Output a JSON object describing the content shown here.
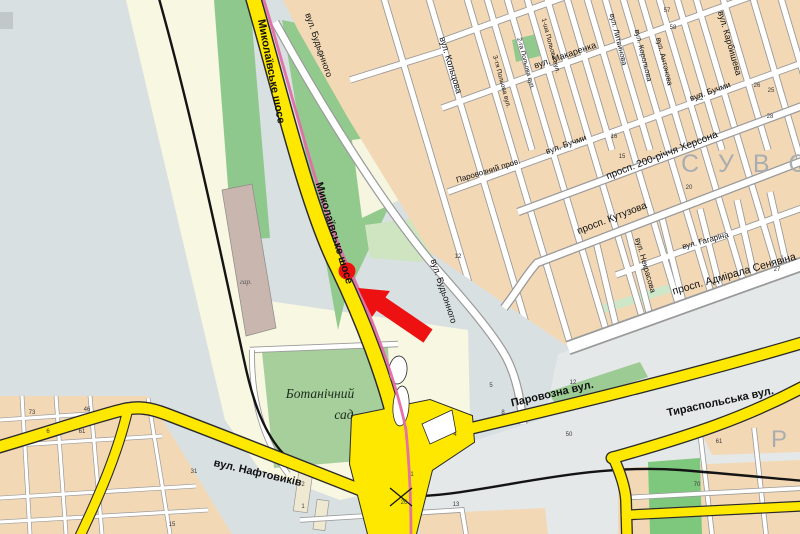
{
  "map": {
    "type": "city-street-map",
    "colors": {
      "background_field": "#d9e0e1",
      "primary_road_yellow": "#ffe800",
      "road_casing": "#2a2a2a",
      "minor_street_white": "#ffffff",
      "urban_block_tan": "#f3d8b6",
      "park_green": "#92ca8e",
      "garden_green": "#a6cf9c",
      "pale_land": "#f8f7e1",
      "tram_line_pink": "#e36ba6",
      "railway_black": "#141414",
      "marker_red": "#ee1111",
      "district_letters_grey": "#a9adb0"
    },
    "marker": {
      "dot_x": 347,
      "dot_y": 271,
      "arrow_tip_x": 358,
      "arrow_tip_y": 288
    },
    "labels": [
      {
        "t": "Миколаївське шосе",
        "x": 268,
        "y": 72,
        "r": 79,
        "s": 11,
        "w": 700
      },
      {
        "t": "Миколаївське шосе",
        "x": 331,
        "y": 234,
        "r": 73,
        "s": 11,
        "w": 700
      },
      {
        "t": "вул. Будьонного",
        "x": 316,
        "y": 46,
        "r": 71,
        "s": 9
      },
      {
        "t": "вул. Будьонного",
        "x": 441,
        "y": 292,
        "r": 72,
        "s": 9
      },
      {
        "t": "вул. Кольцова",
        "x": 448,
        "y": 66,
        "r": 73,
        "s": 9
      },
      {
        "t": "вул. Карбишева",
        "x": 727,
        "y": 44,
        "r": 74,
        "s": 9
      },
      {
        "t": "вул. Литвинова",
        "x": 616,
        "y": 40,
        "r": 76,
        "s": 7.5
      },
      {
        "t": "вул. Корольова",
        "x": 641,
        "y": 56,
        "r": 76,
        "s": 7.5
      },
      {
        "t": "вул. Антонова",
        "x": 662,
        "y": 62,
        "r": 76,
        "s": 7.5
      },
      {
        "t": "вул. Макаренка",
        "x": 566,
        "y": 58,
        "r": -19,
        "s": 9
      },
      {
        "t": "Паровозний пров.",
        "x": 489,
        "y": 173,
        "r": -17,
        "s": 8
      },
      {
        "t": "вул. Бучми",
        "x": 567,
        "y": 147,
        "r": -20,
        "s": 8.5
      },
      {
        "t": "вул. Бучми",
        "x": 711,
        "y": 94,
        "r": -20,
        "s": 8.5
      },
      {
        "t": "просп. 200-річчя Херсона",
        "x": 663,
        "y": 158,
        "r": -21,
        "s": 10
      },
      {
        "t": "просп. Кутузова",
        "x": 613,
        "y": 221,
        "r": -21,
        "s": 10
      },
      {
        "t": "вул. Некрасова",
        "x": 643,
        "y": 266,
        "r": 74,
        "s": 8
      },
      {
        "t": "вул. Гагаріна",
        "x": 706,
        "y": 243,
        "r": -15,
        "s": 8
      },
      {
        "t": "просп. Адмірала Сенявіна",
        "x": 735,
        "y": 277,
        "r": -16,
        "s": 10.5
      },
      {
        "t": "Паровозна вул.",
        "x": 553,
        "y": 397,
        "r": -13,
        "s": 11,
        "w": 700
      },
      {
        "t": "Тираспольська вул.",
        "x": 721,
        "y": 405,
        "r": -12,
        "s": 11,
        "w": 700
      },
      {
        "t": "вул. Нафтовиків",
        "x": 257,
        "y": 476,
        "r": 13,
        "s": 11,
        "w": 700
      },
      {
        "t": "1-ша Польова вул.",
        "x": 549,
        "y": 46,
        "r": 75,
        "s": 6.5
      },
      {
        "t": "2-га Польова вул.",
        "x": 524,
        "y": 64,
        "r": 75,
        "s": 6.5
      },
      {
        "t": "3-тя Польова вул.",
        "x": 500,
        "y": 82,
        "r": 75,
        "s": 6.5
      },
      {
        "t": "Ботанічний",
        "x": 320,
        "y": 398,
        "s": 13.5,
        "f": "serif",
        "i": 1,
        "c": "#1d2c1d"
      },
      {
        "t": "сад",
        "x": 344,
        "y": 419,
        "s": 13.5,
        "f": "serif",
        "i": 1,
        "c": "#1d2c1d"
      },
      {
        "t": "гар.",
        "x": 246,
        "y": 284,
        "s": 7.5,
        "f": "serif",
        "i": 1,
        "c": "#5a5a5a"
      },
      {
        "t": "С У В О Р",
        "x": 681,
        "y": 172,
        "s": 25,
        "c": "#a9adb0",
        "ls": 6,
        "a": "start"
      },
      {
        "t": "Р",
        "x": 779,
        "y": 447,
        "s": 24,
        "c": "#a9adb0"
      }
    ],
    "house_numbers": [
      {
        "t": "57",
        "x": 667,
        "y": 12
      },
      {
        "t": "58",
        "x": 673,
        "y": 29
      },
      {
        "t": "26",
        "x": 757,
        "y": 87
      },
      {
        "t": "25",
        "x": 771,
        "y": 92
      },
      {
        "t": "28",
        "x": 770,
        "y": 118
      },
      {
        "t": "22",
        "x": 700,
        "y": 100
      },
      {
        "t": "16",
        "x": 614,
        "y": 138
      },
      {
        "t": "15",
        "x": 622,
        "y": 158
      },
      {
        "t": "20",
        "x": 689,
        "y": 189
      },
      {
        "t": "27",
        "x": 777,
        "y": 271
      },
      {
        "t": "12",
        "x": 573,
        "y": 384
      },
      {
        "t": "50",
        "x": 569,
        "y": 436
      },
      {
        "t": "70",
        "x": 697,
        "y": 486
      },
      {
        "t": "61",
        "x": 719,
        "y": 443
      },
      {
        "t": "4",
        "x": 455,
        "y": 436
      },
      {
        "t": "5",
        "x": 491,
        "y": 387
      },
      {
        "t": "8",
        "x": 503,
        "y": 414
      },
      {
        "t": "1",
        "x": 412,
        "y": 476
      },
      {
        "t": "26",
        "x": 404,
        "y": 504
      },
      {
        "t": "13",
        "x": 456,
        "y": 506
      },
      {
        "t": "2",
        "x": 303,
        "y": 486
      },
      {
        "t": "1",
        "x": 303,
        "y": 508
      },
      {
        "t": "73",
        "x": 32,
        "y": 414
      },
      {
        "t": "46",
        "x": 87,
        "y": 411
      },
      {
        "t": "61",
        "x": 82,
        "y": 433
      },
      {
        "t": "6",
        "x": 48,
        "y": 433
      },
      {
        "t": "31",
        "x": 194,
        "y": 473
      },
      {
        "t": "15",
        "x": 172,
        "y": 526
      },
      {
        "t": "52",
        "x": 320,
        "y": 56
      },
      {
        "t": "12",
        "x": 458,
        "y": 258
      }
    ]
  }
}
